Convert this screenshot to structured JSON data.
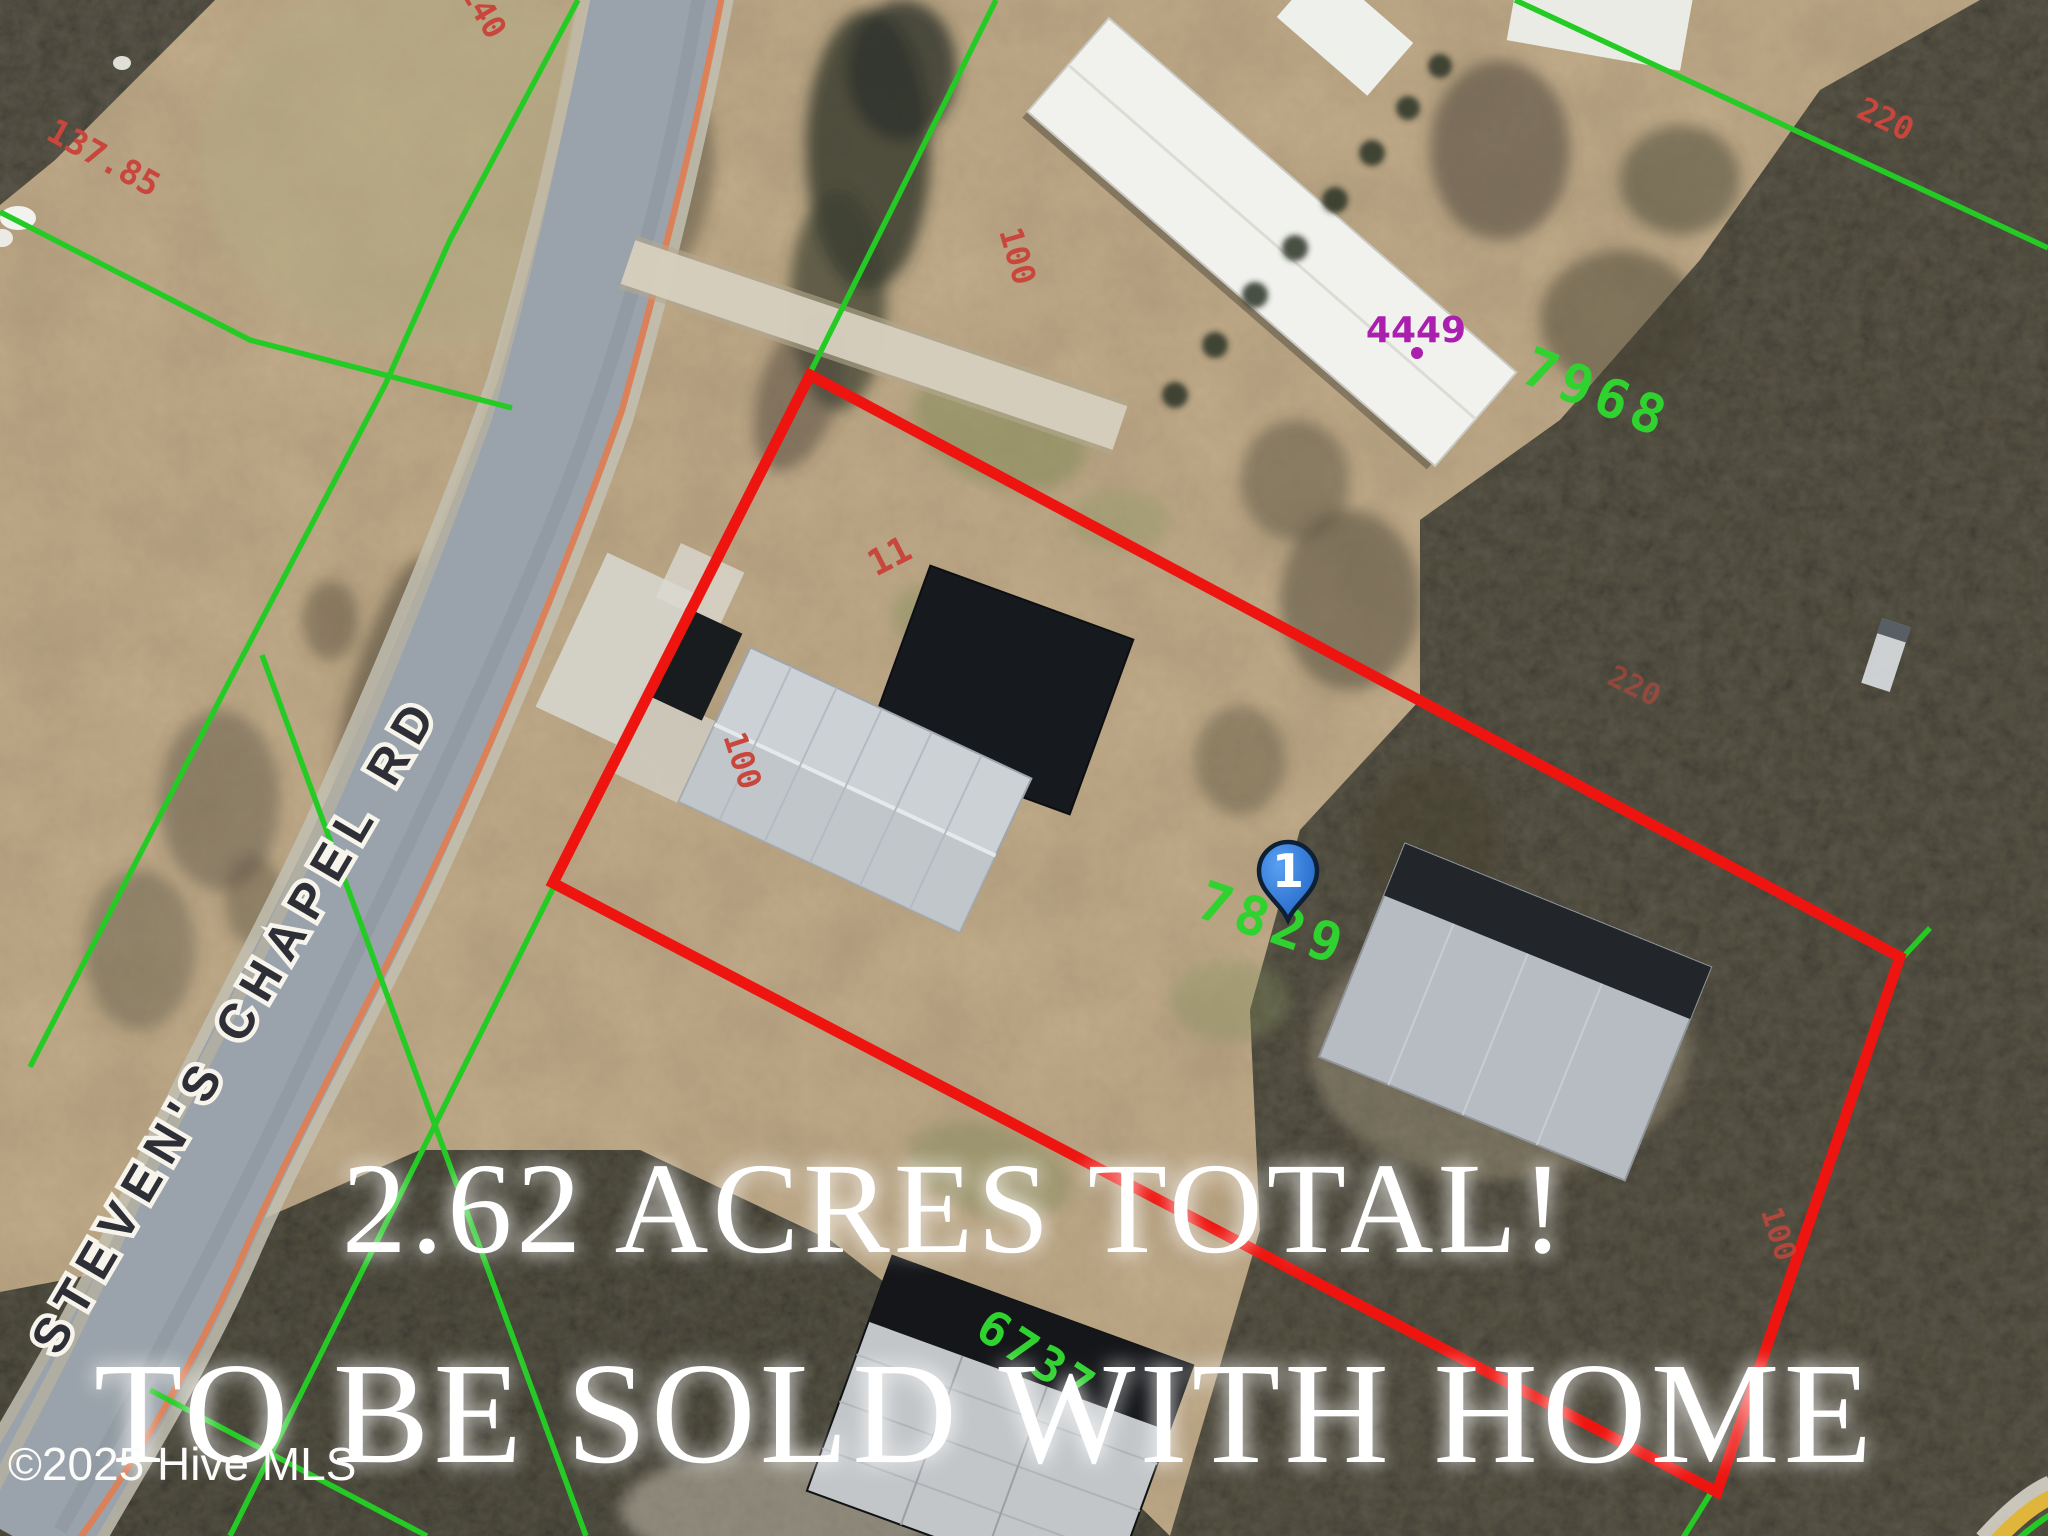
{
  "map": {
    "road": {
      "label": "STEVEN'S CHAPEL RD",
      "centerline_color": "#de7f54"
    },
    "captions": {
      "line1": "2.62 ACRES TOTAL!",
      "line2": "TO BE SOLD WITH HOME",
      "copyright": "©2025 Hive MLS",
      "color": "#ffffff"
    },
    "marker": {
      "number": "1",
      "fill": "#2a7ce0"
    },
    "parcels": {
      "subject_id": "7829",
      "northeast_id": "7968",
      "south_id": "6737",
      "address_label": "4449",
      "subject_boundary_color": "#ee1510",
      "neighbor_boundary_color": "#25cb25",
      "parcel_id_color": "#30d230",
      "address_color": "#aa1fae"
    },
    "dimensions": {
      "color": "#c8463c",
      "west_upper": "137.85",
      "top_edge": "140",
      "driveway_side": "100",
      "top_inner": "11",
      "west_side": "100",
      "northeast_side": "220",
      "east_inner": "220",
      "southeast_side": "100"
    }
  }
}
